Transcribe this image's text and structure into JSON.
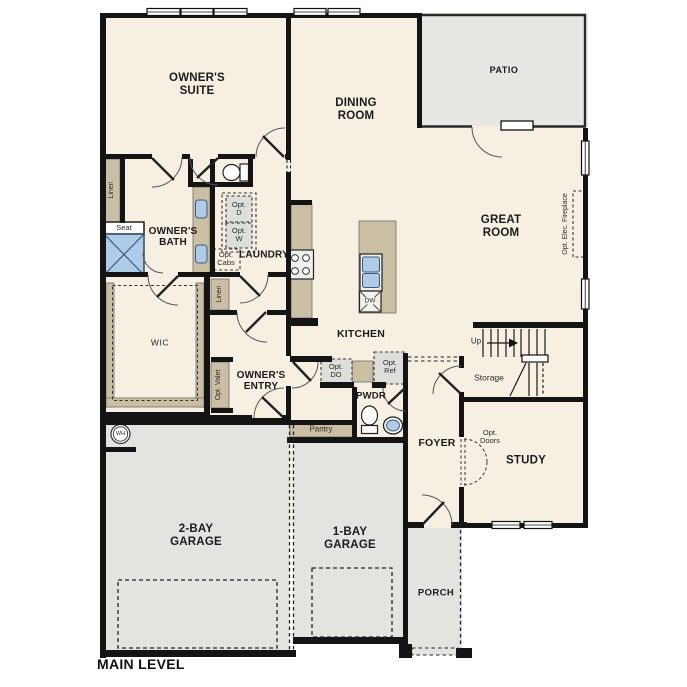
{
  "plan": {
    "title": "MAIN LEVEL",
    "rooms": {
      "owners_suite": "OWNER'S SUITE",
      "owners_bath": "OWNER'S BATH",
      "wic": "WIC",
      "laundry": "LAUNDRY",
      "owners_entry": "OWNER'S ENTRY",
      "dining_room": "DINING ROOM",
      "kitchen": "KITCHEN",
      "great_room": "GREAT ROOM",
      "patio": "PATIO",
      "pwdr": "PWDR",
      "pantry": "Pantry",
      "foyer": "FOYER",
      "study": "STUDY",
      "storage": "Storage",
      "porch": "PORCH",
      "garage_2bay": "2-BAY GARAGE",
      "garage_1bay": "1-BAY GARAGE"
    },
    "annotations": {
      "linen_bath": "Linen",
      "seat": "Seat",
      "opt_d": "Opt. D",
      "opt_w": "Opt. W",
      "opt_cabs": "Opt. Cabs",
      "linen_laundry": "Linen",
      "opt_valet": "Opt. Valet",
      "opt_do": "Opt. DO",
      "opt_ref": "Opt. Ref",
      "dw": "DW",
      "wh": "WH",
      "up": "Up",
      "opt_doors": "Opt. Doors",
      "opt_elec_fireplace": "Opt. Elec. Fireplace"
    },
    "colors": {
      "floor": "#F7EFE2",
      "hardscape": "#E3E3E0",
      "casework": "#CBBFA3",
      "fixture_blue": "#AECBEA",
      "wall": "#141414"
    }
  }
}
